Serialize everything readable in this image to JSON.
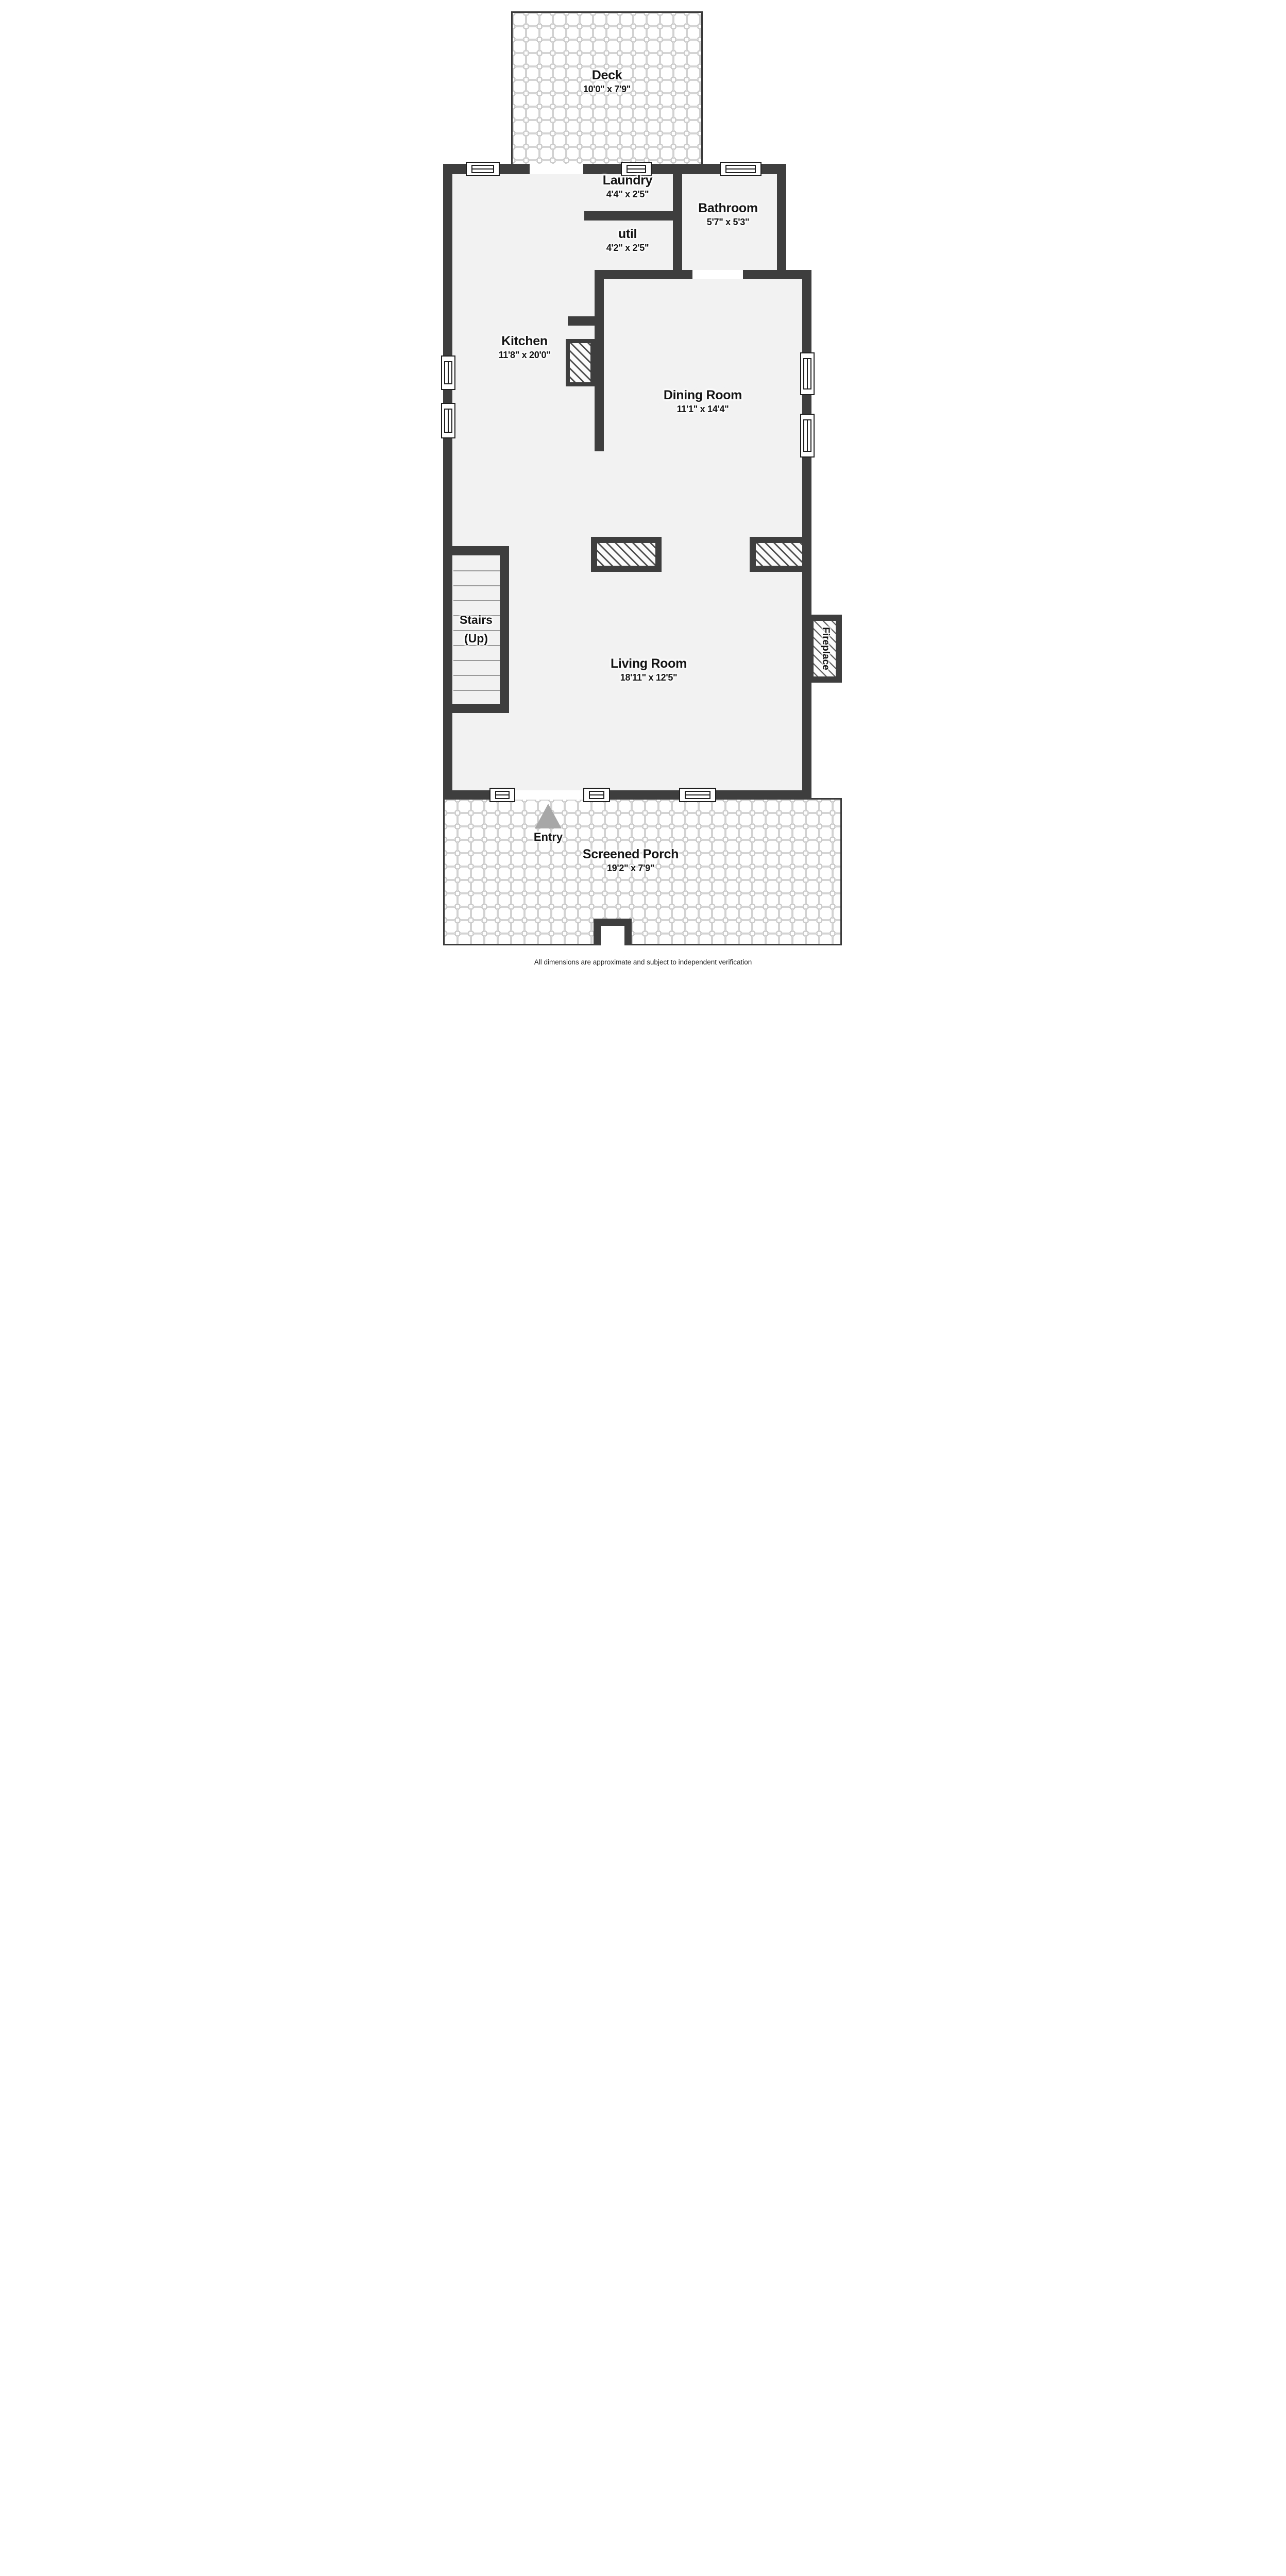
{
  "plan": {
    "rooms": {
      "deck": {
        "name": "Deck",
        "dims": "10'0\" x 7'9\""
      },
      "laundry": {
        "name": "Laundry",
        "dims": "4'4\" x 2'5\""
      },
      "util": {
        "name": "util",
        "dims": "4'2\" x 2'5\""
      },
      "bathroom": {
        "name": "Bathroom",
        "dims": "5'7\" x 5'3\""
      },
      "kitchen": {
        "name": "Kitchen",
        "dims": "11'8\" x 20'0\""
      },
      "dining": {
        "name": "Dining Room",
        "dims": "11'1\" x 14'4\""
      },
      "living": {
        "name": "Living Room",
        "dims": "18'11\" x 12'5\""
      },
      "porch": {
        "name": "Screened Porch",
        "dims": "19'2\" x 7'9\""
      },
      "stairs": {
        "line1": "Stairs",
        "line2": "(Up)"
      },
      "fireplace": {
        "name": "Fireplace"
      },
      "entry": {
        "name": "Entry"
      }
    },
    "footer": {
      "disclaimer": "All dimensions are approximate and subject to independent verification"
    },
    "colors": {
      "wall": "#3e3e3e",
      "floor": "#f2f2f2",
      "tile_grout": "#c7c7c7",
      "hatch": "#4a4a4a",
      "entry_arrow": "#a7a7a7",
      "text": "#141414"
    }
  }
}
